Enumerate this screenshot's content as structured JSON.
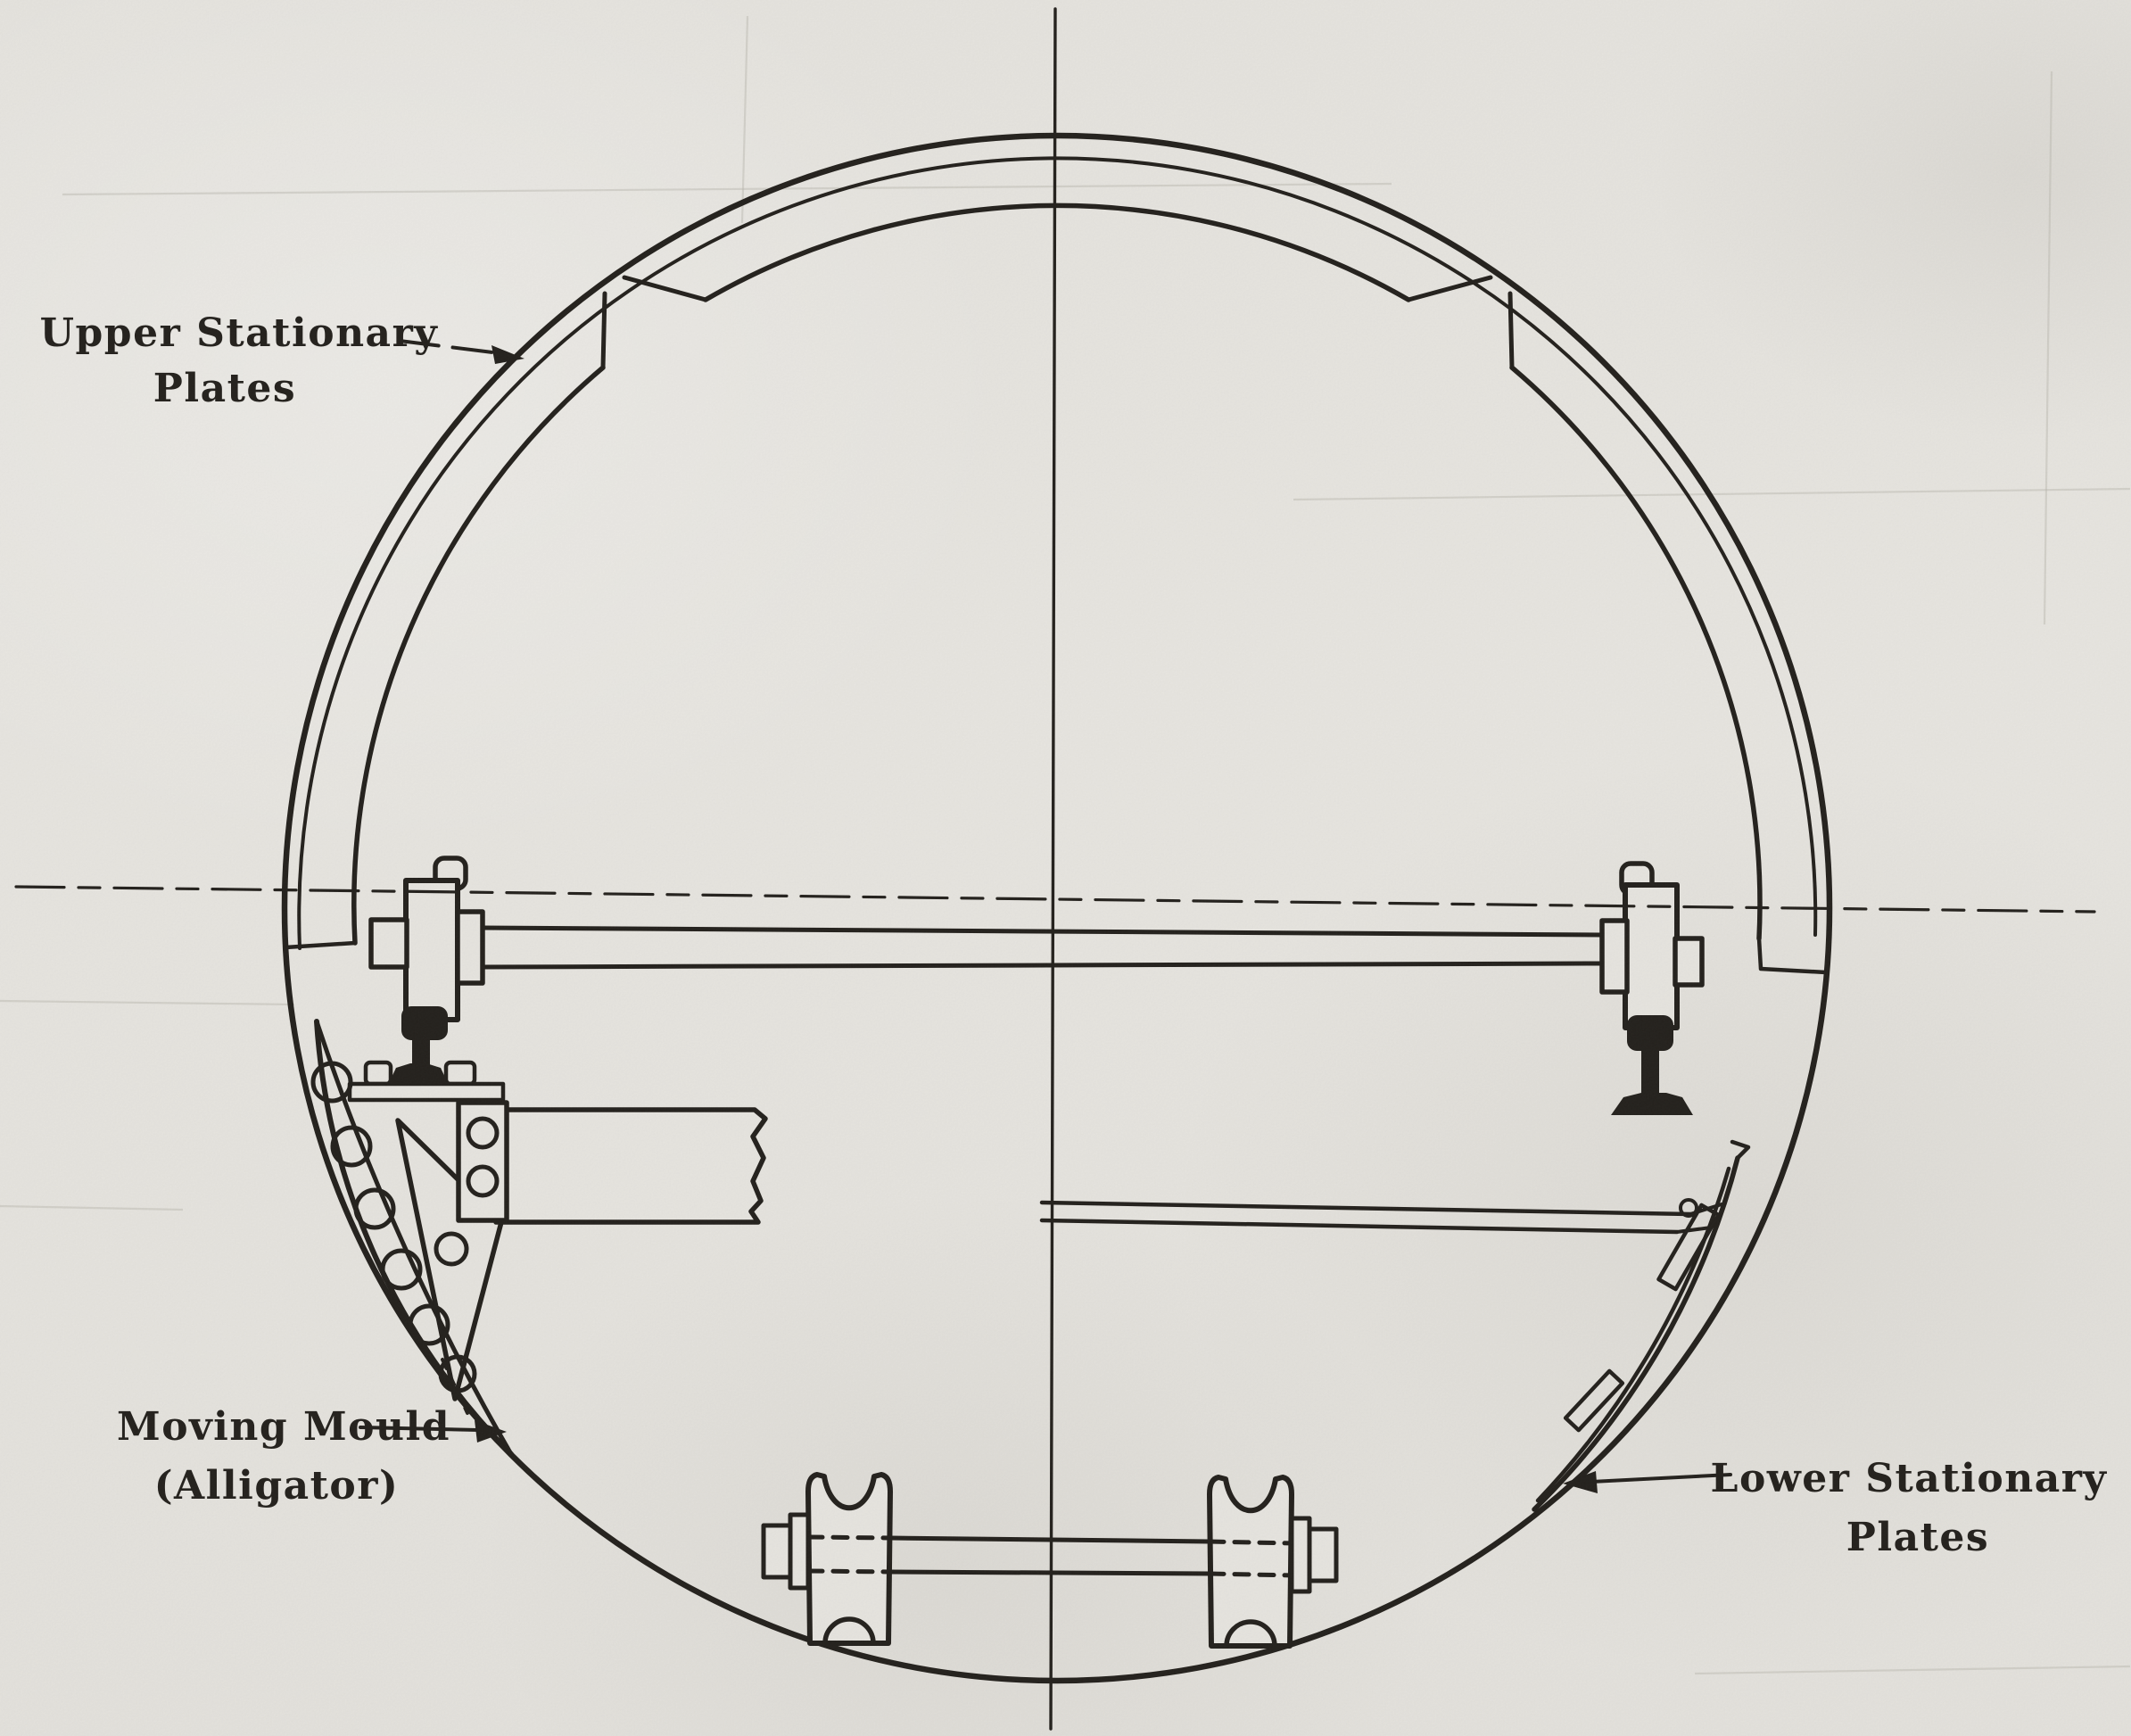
{
  "figure": {
    "title": "Tunnel lining mould cross-section: stationary plates and moving mould (alligator)",
    "labels": {
      "upper_stationary": {
        "line1": "Upper Stationary",
        "line2": "Plates"
      },
      "moving_mould": {
        "line1": "Moving Mould",
        "line2": "(Alligator)"
      },
      "lower_stationary": {
        "line1": "Lower Stationary",
        "line2": "Plates"
      }
    },
    "colors": {
      "ink": "#1c1915",
      "paper": "#e8e6e1"
    }
  }
}
